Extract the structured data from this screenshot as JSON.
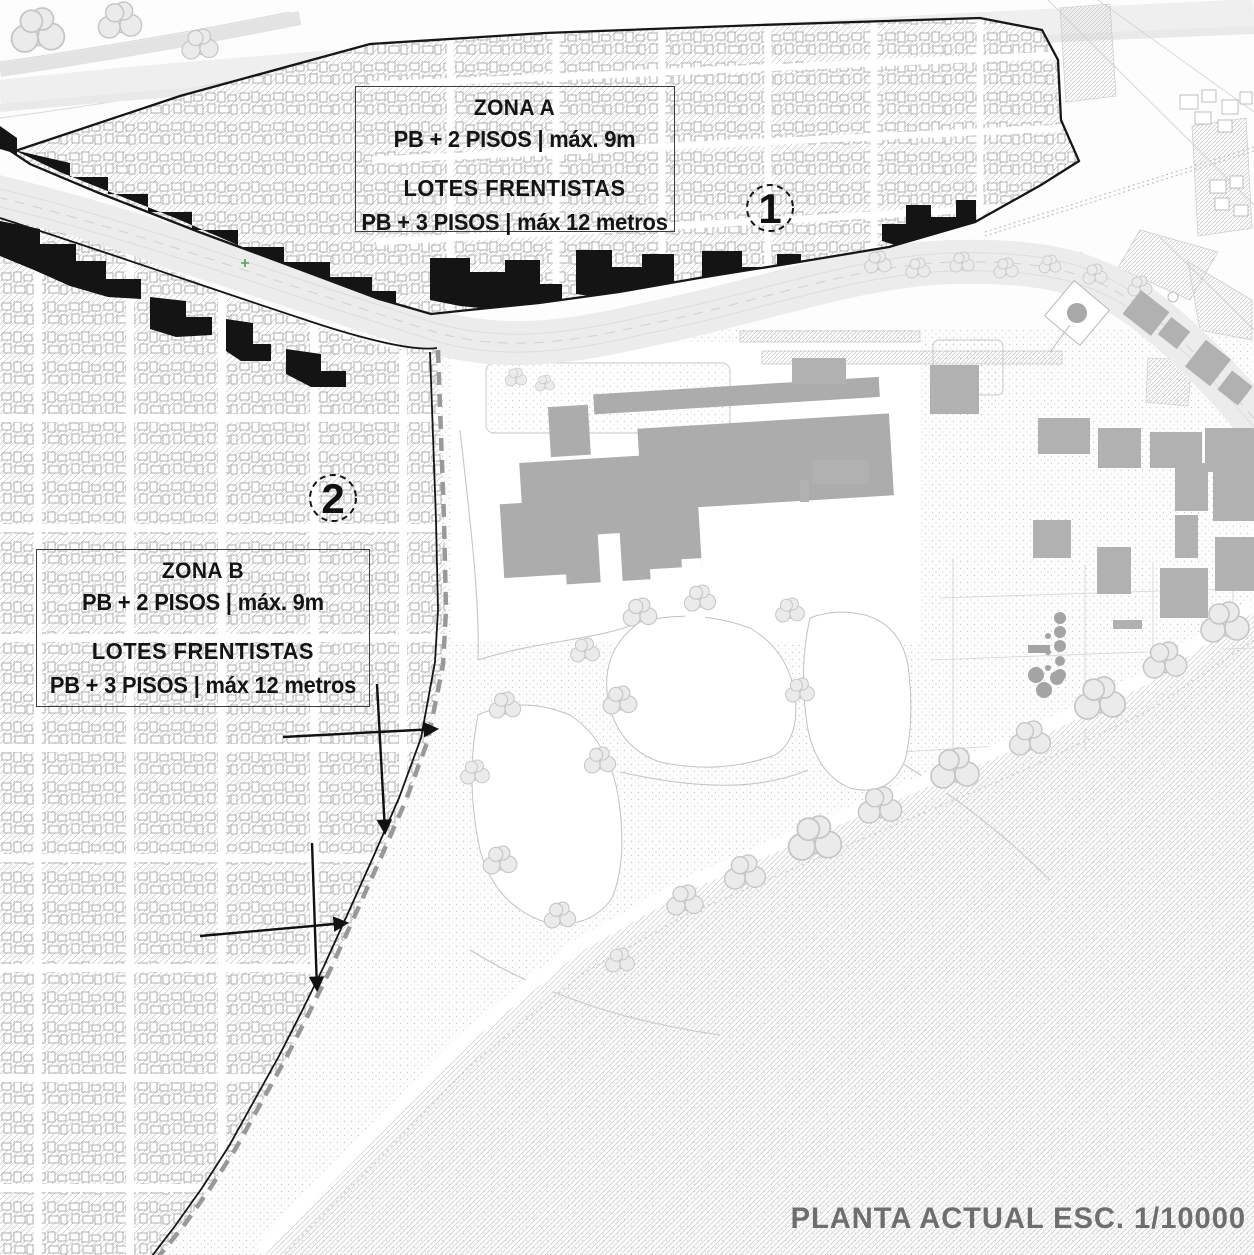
{
  "map": {
    "caption": "PLANTA ACTUAL ESC. 1/10000",
    "zona_a": {
      "title": "ZONA A",
      "rule_general": "PB + 2 PISOS | máx. 9m",
      "frontage_heading": "LOTES FRENTISTAS",
      "rule_frontage": "PB + 3 PISOS | máx 12 metros",
      "marker": "1"
    },
    "zona_b": {
      "title": "ZONA B",
      "rule_general": "PB + 2 PISOS | máx. 9m",
      "frontage_heading": "LOTES FRENTISTAS",
      "rule_frontage": "PB + 3 PISOS | máx 12 metros",
      "marker": "2"
    }
  },
  "colors": {
    "ink": "#161616",
    "caption_gray": "#6e6e6e",
    "building_gray": "#acacac",
    "boundary_dash": "#999999",
    "survey_marker_green": "#52a052"
  }
}
